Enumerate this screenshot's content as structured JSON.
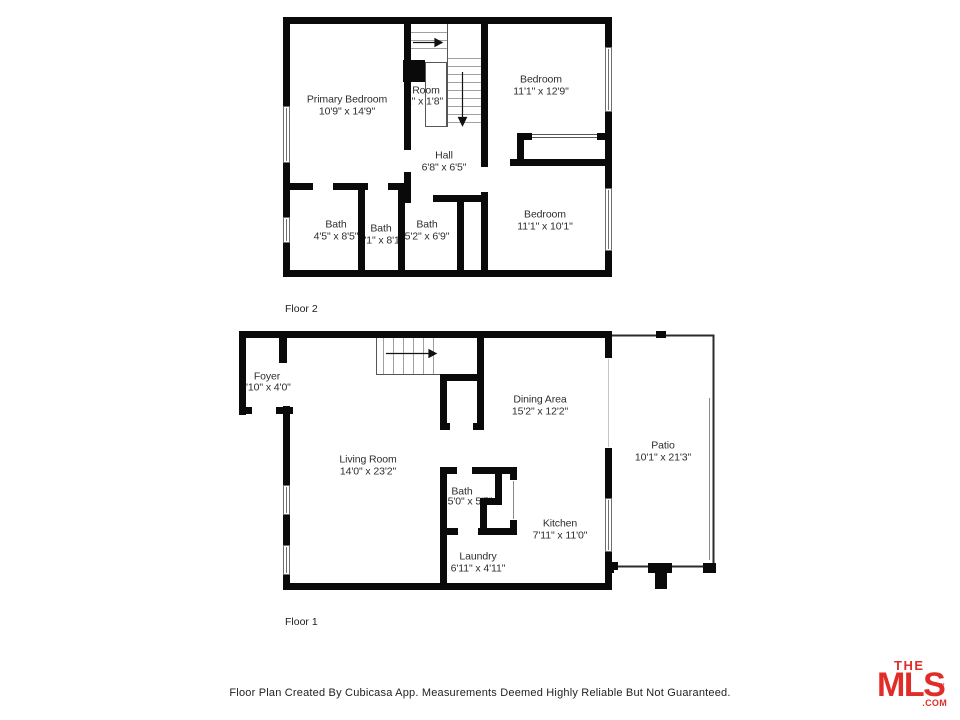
{
  "colors": {
    "wall": "#0a0a0a",
    "logo_red": "#E02D28"
  },
  "footer": {
    "text": "Floor Plan Created By Cubicasa App. Measurements Deemed Highly Reliable But Not Guaranteed."
  },
  "logo": {
    "the": "THE",
    "mls": "MLS",
    "tm": "™",
    "com": ".COM"
  },
  "floors": [
    {
      "caption": "Floor 2",
      "rooms": [
        {
          "name": "Primary Bedroom",
          "dims": "10'9\" x 14'9\""
        },
        {
          "name": "Room",
          "dims": "'2\" x 1'8\""
        },
        {
          "name": "Bedroom",
          "dims": "11'1\" x 12'9\""
        },
        {
          "name": "Hall",
          "dims": "6'8\" x 6'5\""
        },
        {
          "name": "Bath",
          "dims": "4'5\" x 8'5\""
        },
        {
          "name": "Bath",
          "dims": "3'1\" x 8'1\""
        },
        {
          "name": "Bath",
          "dims": "5'2\" x 6'9\""
        },
        {
          "name": "Bedroom",
          "dims": "11'1\" x 10'1\""
        }
      ]
    },
    {
      "caption": "Floor 1",
      "rooms": [
        {
          "name": "Foyer",
          "dims": "'10\" x 4'0\""
        },
        {
          "name": "Living Room",
          "dims": "14'0\" x 23'2\""
        },
        {
          "name": "Dining Area",
          "dims": "15'2\" x 12'2\""
        },
        {
          "name": "Patio",
          "dims": "10'1\" x 21'3\""
        },
        {
          "name": "Bath",
          "dims": "5'0\" x 5'5\""
        },
        {
          "name": "Kitchen",
          "dims": "7'11\" x 11'0\""
        },
        {
          "name": "Laundry",
          "dims": "6'11\" x 4'11\""
        }
      ]
    }
  ]
}
